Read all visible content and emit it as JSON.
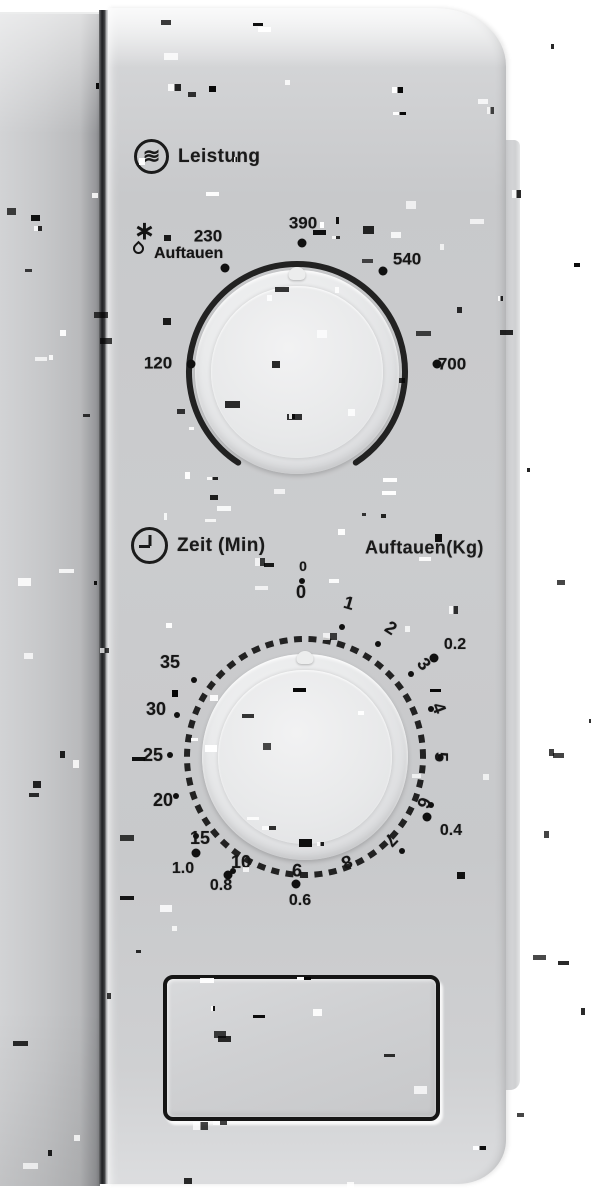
{
  "device": "microwave-control-panel",
  "colors": {
    "panel": "#c9cacc",
    "door": "#c4c5c7",
    "text": "#161616",
    "mark": "#101010",
    "background": "#ffffff"
  },
  "power_dial": {
    "heading": "Leistung",
    "icon": "microwave-waves-icon",
    "icon_glyph": "≋",
    "defrost": {
      "label": "Auftauen",
      "snowflake_glyph": "∗",
      "icons": [
        "snowflake-icon",
        "droplet-icon"
      ]
    },
    "positions": [
      {
        "label": "120",
        "x": 158,
        "y": 363
      },
      {
        "label": "230",
        "x": 208,
        "y": 236
      },
      {
        "label": "390",
        "x": 303,
        "y": 223
      },
      {
        "label": "540",
        "x": 407,
        "y": 259
      },
      {
        "label": "700",
        "x": 452,
        "y": 364
      }
    ],
    "dots": [
      [
        191,
        364
      ],
      [
        225,
        268
      ],
      [
        302,
        243
      ],
      [
        383,
        271
      ],
      [
        437,
        364
      ]
    ]
  },
  "timer_dial": {
    "heading": "Zeit (Min)",
    "icon": "clock-icon",
    "kg_heading": "Auftauen(Kg)",
    "minutes": [
      {
        "label": "0",
        "x": 301,
        "y": 592,
        "rot": 0
      },
      {
        "label": "1",
        "x": 349,
        "y": 603,
        "rot": 16
      },
      {
        "label": "2",
        "x": 391,
        "y": 628,
        "rot": 33
      },
      {
        "label": "3",
        "x": 424,
        "y": 664,
        "rot": 52
      },
      {
        "label": "4",
        "x": 439,
        "y": 708,
        "rot": 69
      },
      {
        "label": "5",
        "x": 441,
        "y": 757,
        "rot": 90
      },
      {
        "label": "6",
        "x": 424,
        "y": 803,
        "rot": 111
      },
      {
        "label": "7",
        "x": 391,
        "y": 840,
        "rot": 134
      },
      {
        "label": "8",
        "x": 347,
        "y": 862,
        "rot": 158
      },
      {
        "label": "9",
        "x": 297,
        "y": 870,
        "rot": 182
      },
      {
        "label": "10",
        "x": 241,
        "y": 862,
        "rot": 0
      },
      {
        "label": "15",
        "x": 200,
        "y": 838,
        "rot": 0
      },
      {
        "label": "20",
        "x": 163,
        "y": 800,
        "rot": 0
      },
      {
        "label": "25",
        "x": 153,
        "y": 755,
        "rot": 0
      },
      {
        "label": "30",
        "x": 156,
        "y": 709,
        "rot": 0
      },
      {
        "label": "35",
        "x": 170,
        "y": 662,
        "rot": 0
      }
    ],
    "minute_dots": [
      [
        342,
        627
      ],
      [
        378,
        644
      ],
      [
        411,
        674
      ],
      [
        431,
        709
      ],
      [
        440,
        757
      ],
      [
        431,
        805
      ],
      [
        402,
        851
      ],
      [
        233,
        871
      ],
      [
        196,
        836
      ],
      [
        176,
        796
      ],
      [
        170,
        755
      ],
      [
        177,
        715
      ],
      [
        194,
        680
      ],
      [
        302,
        581
      ]
    ],
    "kg": [
      {
        "label": "0",
        "x": 303,
        "y": 566,
        "size": 14
      },
      {
        "label": "0.2",
        "x": 455,
        "y": 645
      },
      {
        "label": "0.4",
        "x": 451,
        "y": 831
      },
      {
        "label": "0.6",
        "x": 300,
        "y": 901
      },
      {
        "label": "0.8",
        "x": 221,
        "y": 886
      },
      {
        "label": "1.0",
        "x": 183,
        "y": 869
      }
    ],
    "kg_dots": [
      [
        434,
        658
      ],
      [
        427,
        817
      ],
      [
        296,
        884
      ],
      [
        228,
        875
      ],
      [
        196,
        853
      ]
    ]
  },
  "door_button": {
    "label": ""
  }
}
